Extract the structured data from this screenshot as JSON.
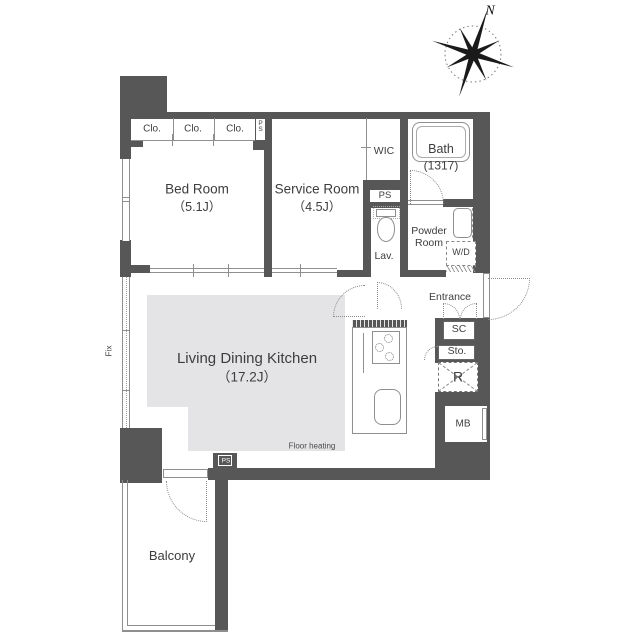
{
  "compass": {
    "north_label": "N"
  },
  "closets": [
    "Clo.",
    "Clo.",
    "Clo."
  ],
  "shafts": {
    "top_ps": "PS",
    "mid_ps": "PS",
    "bottom_ps": "PS"
  },
  "rooms": {
    "bed_room": {
      "name": "Bed Room",
      "area": "（5.1J）"
    },
    "service_room": {
      "name": "Service Room",
      "area": "（4.5J）"
    },
    "living_dining_kitchen": {
      "name": "Living Dining Kitchen",
      "area": "（17.2J）",
      "floor_note": "Floor heating"
    },
    "wic": {
      "name": "WIC"
    },
    "bath": {
      "name": "Bath",
      "size": "(1317)"
    },
    "lavatory": {
      "name": "Lav."
    },
    "powder_room": {
      "name_line1": "Powder",
      "name_line2": "Room"
    },
    "washer_dryer": {
      "name": "W/D"
    },
    "entrance": {
      "name": "Entrance"
    },
    "shoe_closet": {
      "name": "SC"
    },
    "storage": {
      "name": "Sto."
    },
    "refrigerator": {
      "name": "R"
    },
    "meter_box": {
      "name": "MB"
    },
    "balcony": {
      "name": "Balcony"
    }
  },
  "windows": {
    "fixed_label": "Fix"
  },
  "colors": {
    "wall": "#575757",
    "thin_line": "#8f8f8f",
    "floor_heating_fill": "#e4e4e6",
    "text": "#3d3d3d"
  }
}
